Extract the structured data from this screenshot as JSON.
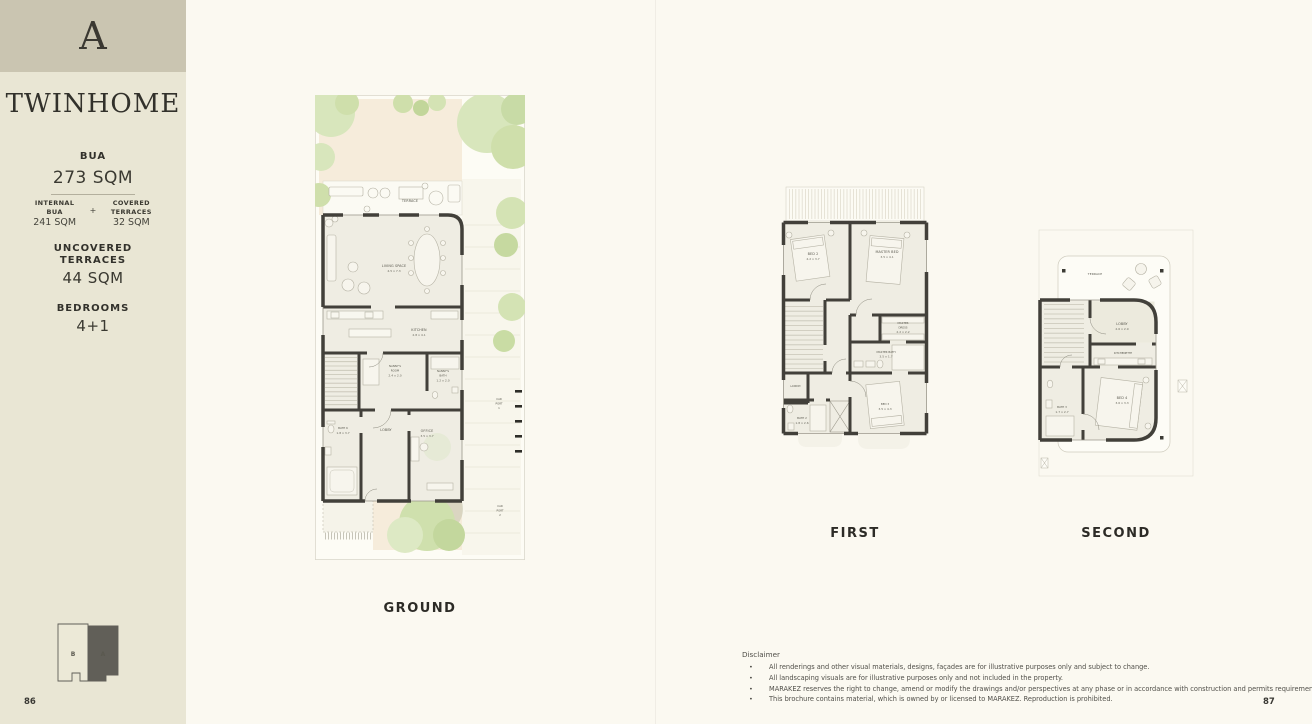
{
  "page": {
    "left_number": "86",
    "right_number": "87"
  },
  "colors": {
    "sidebar_bg": "#e9e6d4",
    "badge_bg": "#cac5b1",
    "page_bg": "#fbf9f1",
    "ink": "#32312b",
    "wall": "#42403a",
    "garden_green": "#cfdfab",
    "paving_peach": "#f6ecdb",
    "minimap_dark": "#615f58"
  },
  "sidebar": {
    "unit_letter": "A",
    "type_name": "TWINHOME",
    "specs": {
      "bua_label": "BUA",
      "bua_value": "273 SQM",
      "internal_bua_label_1": "INTERNAL",
      "internal_bua_label_2": "BUA",
      "internal_bua_value": "241 SQM",
      "plus_sign": "+",
      "covered_label_1": "COVERED",
      "covered_label_2": "TERRACES",
      "covered_value": "32 SQM",
      "uncovered_label_1": "UNCOVERED",
      "uncovered_label_2": "TERRACES",
      "uncovered_value": "44 SQM",
      "bedrooms_label": "BEDROOMS",
      "bedrooms_value": "4+1"
    },
    "minimap": {
      "unit_b_label": "B",
      "unit_a_label": "A"
    }
  },
  "plans": {
    "ground": {
      "caption": "GROUND",
      "rooms": {
        "terrace": [
          "TERRACE"
        ],
        "living": [
          "LIVING SPACE",
          "4.5 x 7.3"
        ],
        "kitchen": [
          "KITCHEN",
          "2.8 x 4.1"
        ],
        "nannys_room": [
          "NANNY'S",
          "ROOM",
          "2.4 x 2.0"
        ],
        "nannys_bath": [
          "NANNY'S",
          "BATH",
          "1.2 x 2.0"
        ],
        "bath6": [
          "BATH 6",
          "1.8 x 3.7"
        ],
        "lobby": [
          "LOBBY"
        ],
        "office": [
          "OFFICE",
          "3.5 x 3.7"
        ],
        "carport1": [
          "CAR",
          "PORT",
          "1"
        ],
        "carport2": [
          "CAR",
          "PORT",
          "2"
        ]
      }
    },
    "first": {
      "caption": "FIRST",
      "rooms": {
        "bed2": [
          "BED 2",
          "4.2 x 3.7"
        ],
        "master_bed": [
          "MASTER BED",
          "3.5 x 4.1"
        ],
        "master_dress": [
          "MASTER",
          "DRESS",
          "2.2 x 2.2"
        ],
        "master_bath": [
          "MASTER BATH",
          "3.5 x 1.7"
        ],
        "laundry": [
          "LAUNDRY"
        ],
        "bath2": [
          "BATH 2",
          "1.8 x 2.6"
        ],
        "bed3": [
          "BED 3",
          "3.5 x 4.3"
        ]
      }
    },
    "second": {
      "caption": "SECOND",
      "rooms": {
        "terrace": [
          "TERRACE"
        ],
        "lobby": [
          "LOBBY",
          "2.6 x 2.9"
        ],
        "kitchenette": [
          "KITCHENETTE"
        ],
        "bed4": [
          "BED 4",
          "3.6 x 3.3"
        ],
        "bath3": [
          "BATH 3",
          "1.7 x 2.7"
        ]
      }
    }
  },
  "disclaimer": {
    "title": "Disclaimer",
    "bullet": "•",
    "items": [
      "All renderings and other visual materials, designs, façades are for illustrative purposes only and subject to change.",
      "All landscaping visuals are for illustrative purposes only and not included in the property.",
      "MARAKEZ reserves the right to change, amend or modify the drawings and/or perspectives at any phase or in accordance with construction and permits requirements.",
      "This brochure contains material, which is owned by or licensed to MARAKEZ. Reproduction is prohibited."
    ]
  }
}
